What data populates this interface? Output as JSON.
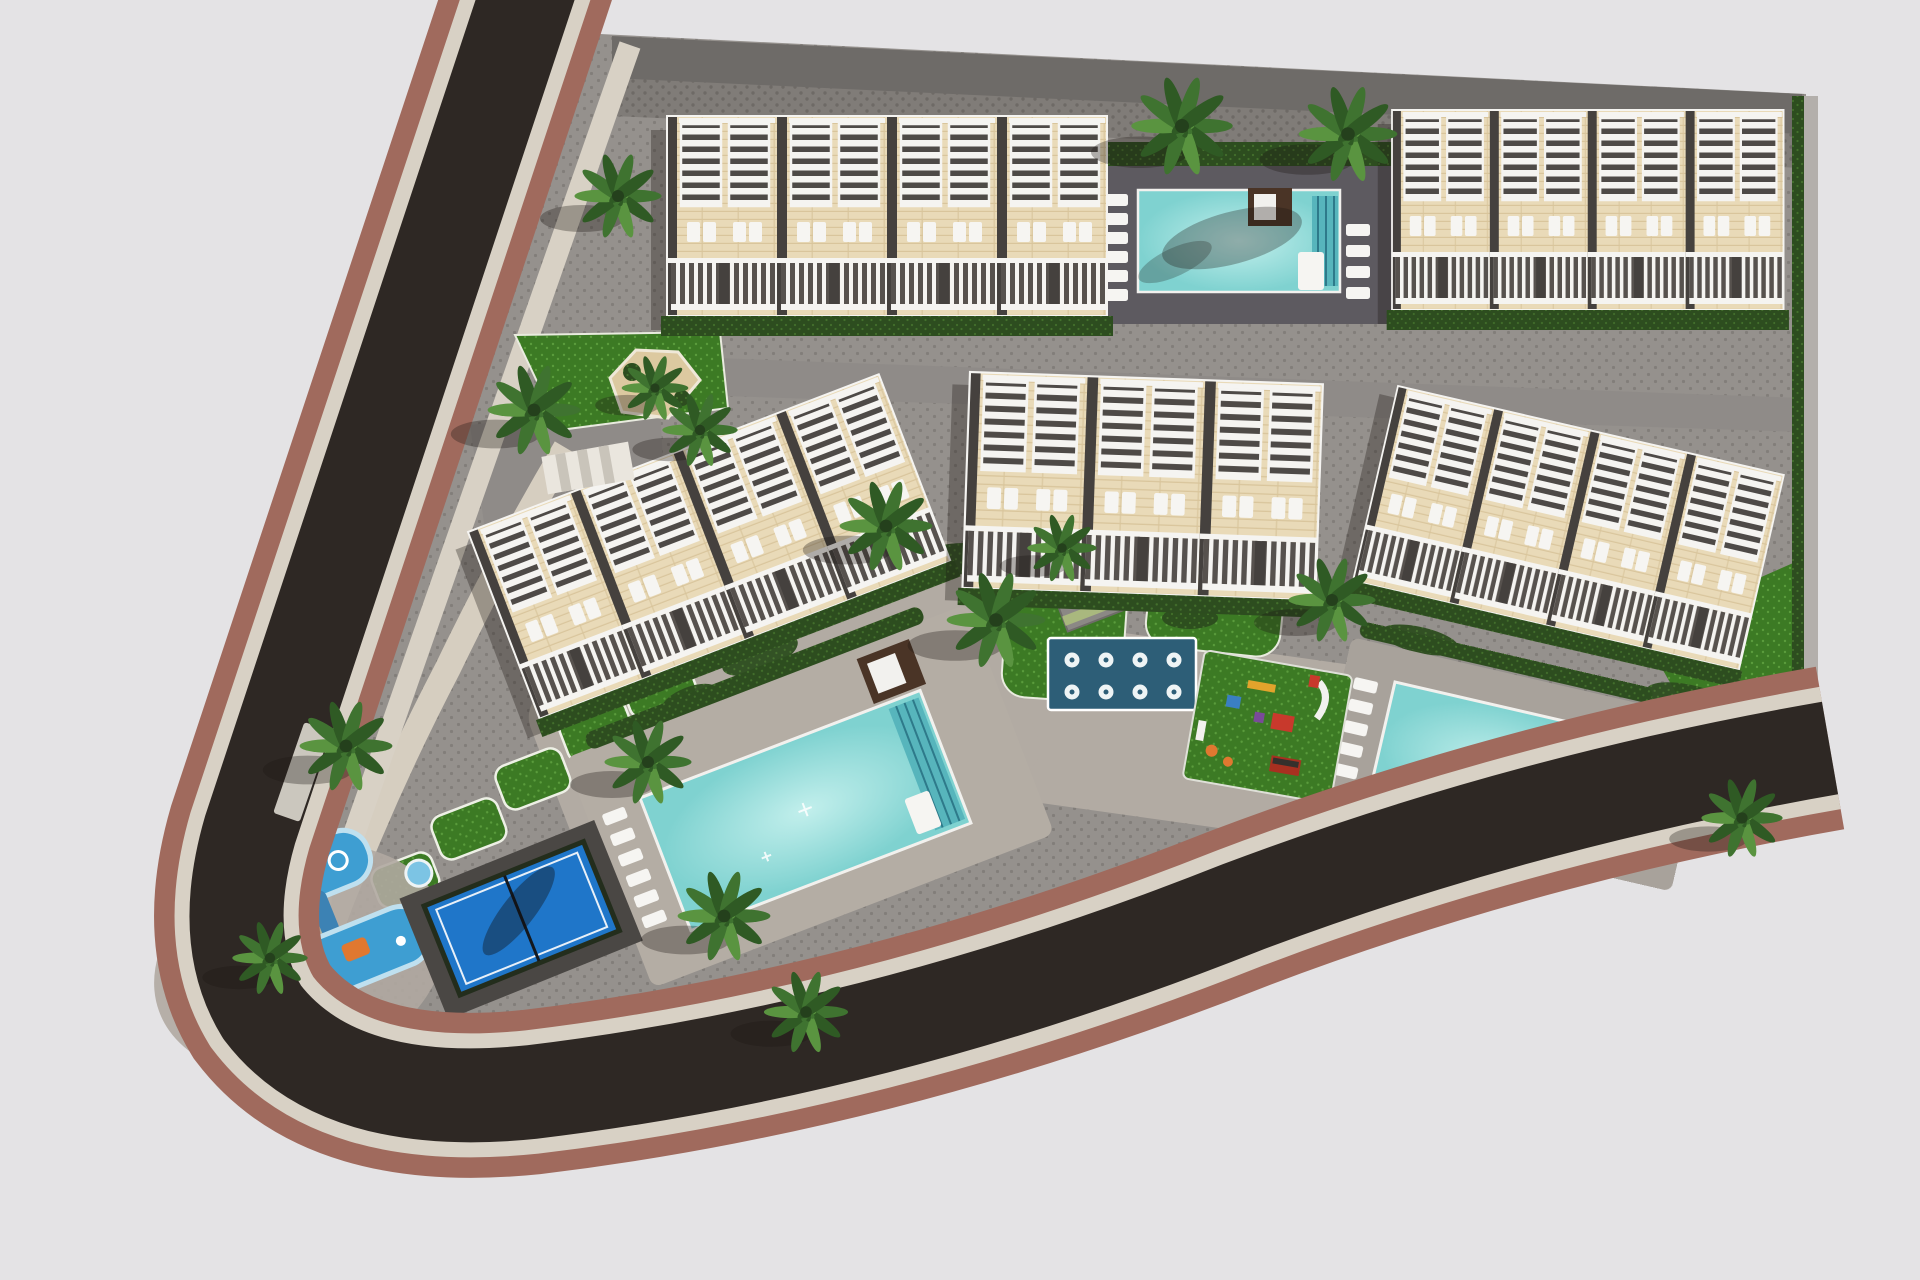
{
  "scene": {
    "title": "Aerial 3D architectural rendering of a residential development: five townhouse blocks with white pergola roof terraces, three turquoise community pools, a water-jet splash pad, children's and toddler playgrounds, a fenced blue padel court, palm-lined lawns and a curved asphalt perimeter road with red-brown sidewalks",
    "type": "architectural-site-plan-render",
    "background": "#e4e3e5"
  },
  "palette": {
    "bg": "#e4e3e5",
    "asphalt": "#2e2824",
    "sidewalkRed": "#a06a5d",
    "curb": "#d8d1c5",
    "paving": "#95918d",
    "pavingDot": "#827e7a",
    "pavingDark": "#807c78",
    "pavingDarkDot": "#6e6a66",
    "promenade": "#b2aba3",
    "pathBeige": "#d6cec0",
    "lime": "#a8ca68",
    "limeDot": "#93b954",
    "roof": "#e9dab8",
    "roofLine": "#d9c59c",
    "pergolaWhite": "#f5f4f1",
    "facadeDark": "#45413e",
    "hedge": "#2d4d1f",
    "hedgeDot": "#43702c",
    "lawn": "#3c7a24",
    "lawnDot": "#5a9c3c",
    "pool": "#7fd2d0",
    "poolLight": "#c2efec",
    "poolStep": "#57b5bc",
    "deckDark": "#5d5a60",
    "splash": "#2d5e77",
    "padel": "#1f76c9",
    "fence": "#232d1c",
    "cabana": "#4a3426",
    "lounger": "#f6f5f2",
    "palm": "#3f7330",
    "palmDark": "#2f5a24",
    "palmLight": "#5a9440",
    "playBlue": "#3e9ed2",
    "playBlueLight": "#bfe0ef",
    "playOrange": "#e07830",
    "playRed": "#c8392c",
    "playYellow": "#e2a32c",
    "sand": "#dcc9a0",
    "wall": "#6e6b68",
    "shadow": "rgba(28,23,19,0.32)"
  },
  "objects": {
    "buildings": [
      {
        "id": "block-1",
        "desc": "Townhouse row, north-west"
      },
      {
        "id": "block-2",
        "desc": "Townhouse row, north-east"
      },
      {
        "id": "block-3",
        "desc": "Townhouse row, west, angled"
      },
      {
        "id": "block-4",
        "desc": "Townhouse row, centre"
      },
      {
        "id": "block-5",
        "desc": "Townhouse row, east, angled"
      }
    ],
    "pools": [
      {
        "id": "pool-north",
        "desc": "Community pool between the northern blocks"
      },
      {
        "id": "pool-main",
        "desc": "Large community pool, south-west courtyard"
      },
      {
        "id": "pool-east",
        "desc": "Community pool, south-east courtyard"
      }
    ],
    "amenities": [
      {
        "id": "splash-pad",
        "desc": "Water-jet splash pad with 8 fountain jets"
      },
      {
        "id": "playground",
        "desc": "Children's playground with slide and climbing units"
      },
      {
        "id": "toddler-playground",
        "desc": "Toddler water play area, south-west corner"
      },
      {
        "id": "padel-court",
        "desc": "Fenced blue padel court"
      },
      {
        "id": "carport-pergola",
        "desc": "Slatted pergola carport"
      },
      {
        "id": "pool-cabanas",
        "desc": "Timber pool cabanas",
        "count": 3
      }
    ],
    "landscape": {
      "palm_trees": 16,
      "hedges": "perimeter and courtyard hedging",
      "lawns": "ornamental lawn islands with white edging"
    },
    "circulation": {
      "perimeter_road": "curved dark asphalt road with red-brown sidewalk bands",
      "internal_street": "grey service lane behind the northern blocks",
      "footpaths": "beige pedestrian paths and light promenade decks"
    }
  }
}
